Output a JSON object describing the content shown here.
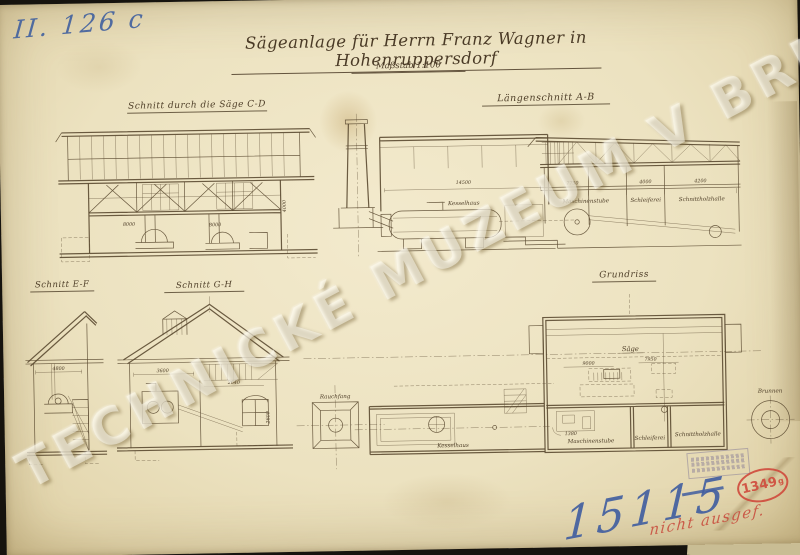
{
  "page": {
    "archive_number": "II. 126 c",
    "inventory_number": "15115",
    "red_note": "nicht ausgef.",
    "stamp_number": "1349",
    "stamp_suffix": "g",
    "watermark": "TECHNICKÉ MUZEUM V BRNĚ"
  },
  "title": {
    "main": "Sägeanlage für Herrn Franz Wagner in Hohenruppersdorf",
    "scale": "Maßstab 1:100"
  },
  "views": {
    "section_cd": {
      "label": "Schnitt durch die Säge C-D",
      "dims": [
        "8000",
        "8000",
        "4000"
      ]
    },
    "long_ab": {
      "label": "Längenschnitt A-B",
      "room_boiler": "Kesselhaus",
      "dim_top": "14500",
      "dims": [
        "7750",
        "4000",
        "4200"
      ],
      "rooms": [
        "Maschinenstube",
        "Schleiferei",
        "Schnittholzhalle"
      ]
    },
    "section_ef": {
      "label": "Schnitt E-F",
      "dims": [
        "4800"
      ]
    },
    "section_gh": {
      "label": "Schnitt G-H",
      "dims": [
        "3600",
        "2640",
        "2600"
      ]
    },
    "plan": {
      "label": "Grundriss",
      "saw": "Säge",
      "well": "Brunnen",
      "chimney": "Rauchfang",
      "room_boiler": "Kesselhaus",
      "rooms": [
        "Maschinenstube",
        "Schleiferei",
        "Schnittholzhalle"
      ],
      "dims": [
        "9000",
        "7950",
        "1380"
      ]
    }
  },
  "colors": {
    "paper": "#efe5c4",
    "ink": "#5b4a31",
    "blue_ink": "#44639f",
    "red_ink": "#cf4638",
    "background": "#16130e",
    "watermark": "#fffdf2"
  }
}
